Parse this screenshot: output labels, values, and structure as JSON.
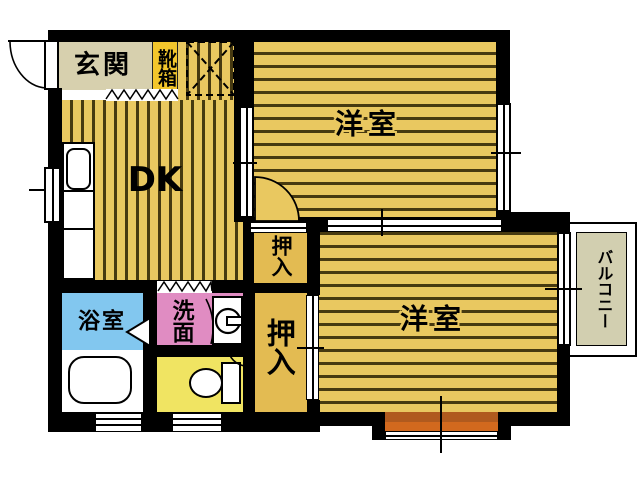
{
  "rooms": {
    "genkan": {
      "label": "玄関"
    },
    "shoebox": {
      "label": "靴箱"
    },
    "dk": {
      "label": "DK"
    },
    "bedroom_top": {
      "label": "洋室"
    },
    "bedroom_bottom": {
      "label": "洋室"
    },
    "closet_upper": {
      "label": "押入"
    },
    "closet_lower": {
      "label": "押入"
    },
    "bathroom": {
      "label": "浴室"
    },
    "washroom": {
      "label": "洗面"
    },
    "balcony": {
      "label": "バルコニー"
    }
  },
  "icons": {
    "entry_door": "door-swing-icon",
    "kitchen_sink": "kitchen-sink-icon",
    "refrigerator_space": "refrigerator-space-icon",
    "bathtub": "bathtub-icon",
    "washing_machine": "washing-machine-icon",
    "toilet": "toilet-icon",
    "bathroom_door": "folding-door-icon"
  },
  "colors": {
    "wall": "#000000",
    "floor_base": "#e9c860",
    "floor_line": "#473a10",
    "genkan": "#d7d0ae",
    "shoebox": "#f3c62c",
    "bathroom": "#82c7ef",
    "washroom": "#e08cc2",
    "toilet_room": "#f0e462",
    "closet": "#e3bb52",
    "balcony": "#d2cfb0",
    "bay_window_dark": "#b05a1e",
    "bay_window_light": "#d2691e"
  }
}
